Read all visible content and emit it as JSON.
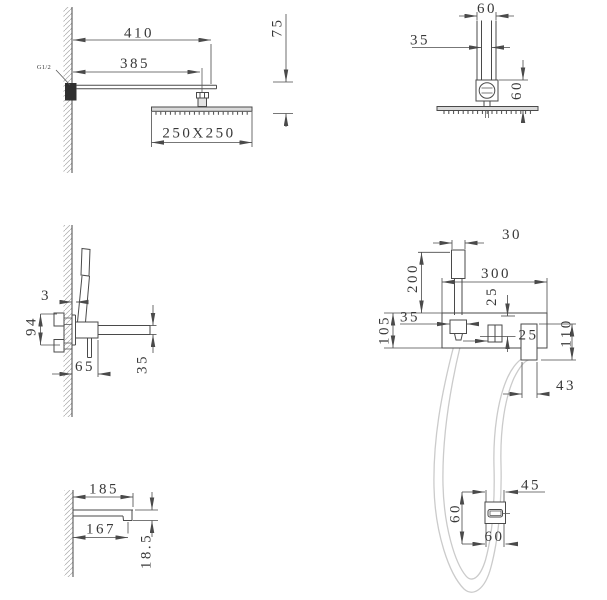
{
  "title": "shower-set-technical-drawing",
  "colors": {
    "line": "#4a4a4a",
    "text": "#383838",
    "hose": "#cbcbcb",
    "plate_fill": "#d9d9d9",
    "background": "#ffffff"
  },
  "views": {
    "arm_side": {
      "d410": "410",
      "d385": "385",
      "d75": "75",
      "d250": "250X250",
      "thread": "G1/2"
    },
    "arm_front": {
      "top60": "60",
      "d35": "35",
      "side60": "60"
    },
    "valve_side": {
      "d3": "3",
      "d94": "94",
      "d65": "65",
      "d35": "35"
    },
    "valve_front": {
      "d30": "30",
      "d200": "200",
      "d300": "300",
      "d25a": "25",
      "d35": "35",
      "d105": "105",
      "d25b": "25",
      "d110": "110",
      "d43": "43"
    },
    "spout_side": {
      "d185": "185",
      "d167": "167",
      "d18_5": "18.5"
    },
    "outlet_front": {
      "d45": "45",
      "left60": "60",
      "bottom60": "60"
    }
  }
}
